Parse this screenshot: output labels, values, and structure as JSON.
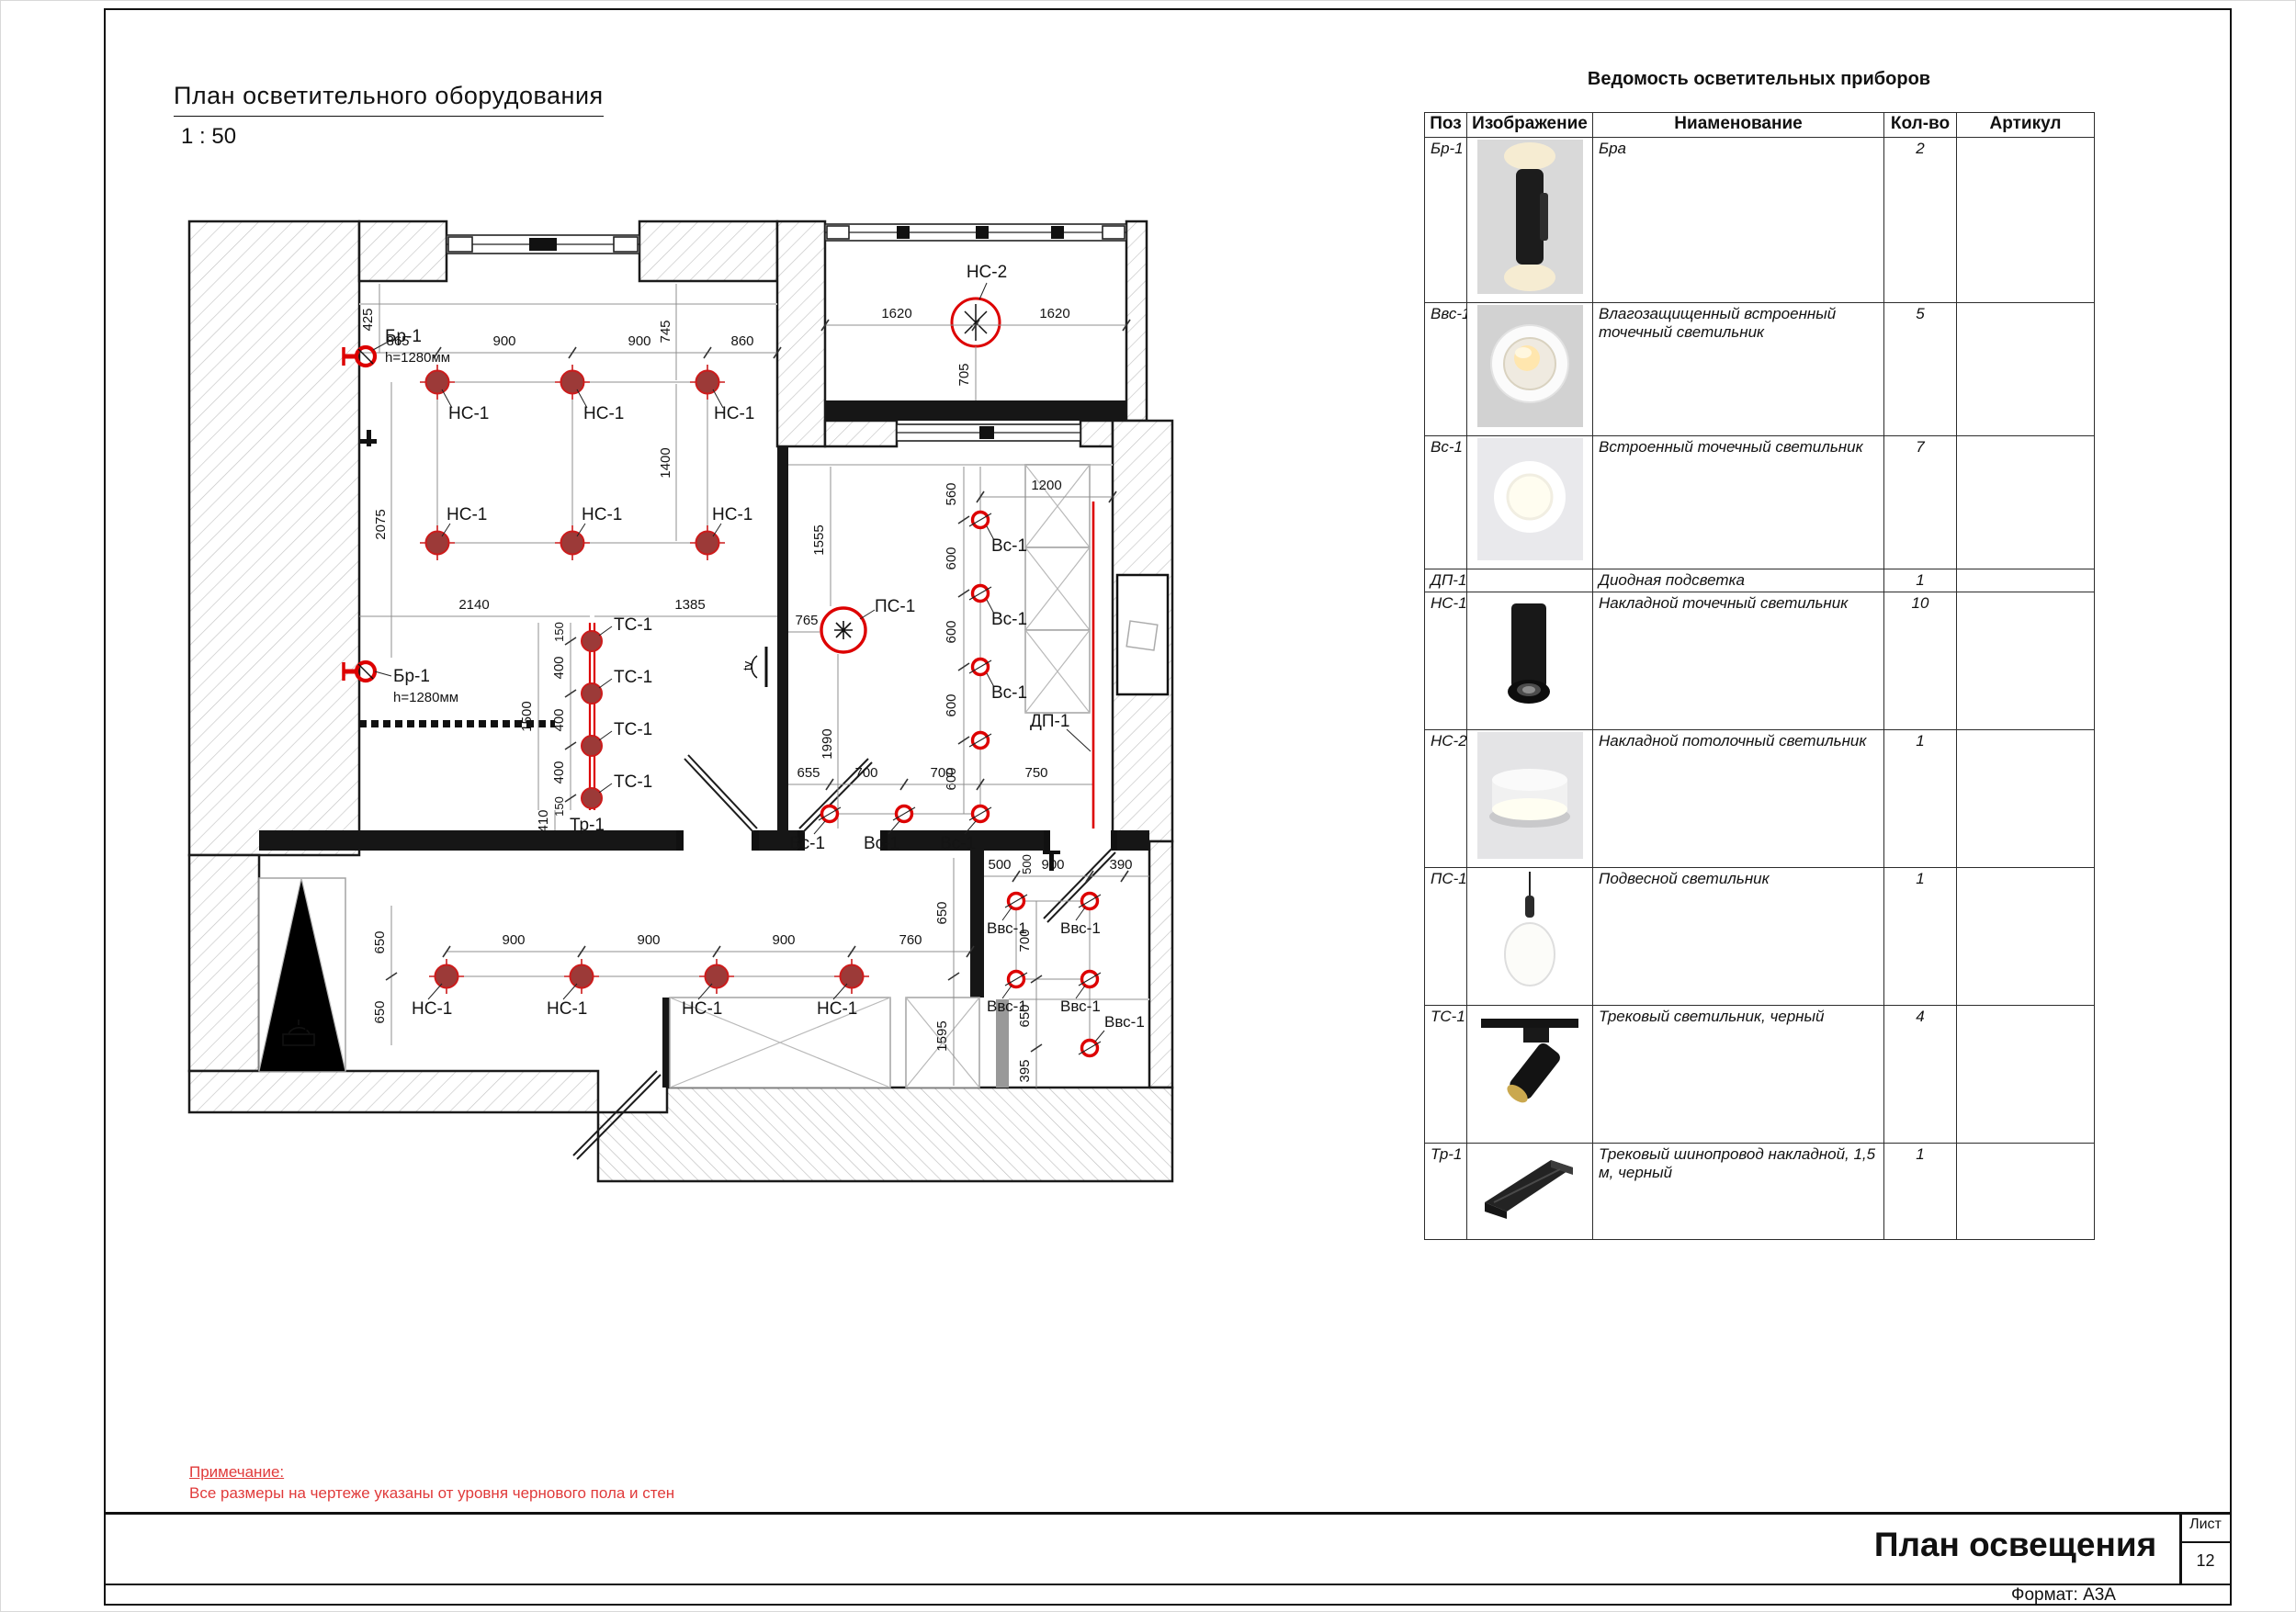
{
  "header": {
    "title": "План осветительного оборудования",
    "scale": "1 : 50"
  },
  "table": {
    "title": "Ведомость осветительных приборов",
    "headers": [
      "Поз",
      "Изображение",
      "Ниаменование",
      "Кол-во",
      "Артикул"
    ],
    "rows": [
      {
        "pos": "Бр-1",
        "name": "Бра",
        "qty": "2",
        "article": ""
      },
      {
        "pos": "Ввс-1",
        "name": "Влагозащищенный встроенный точечный светильник",
        "qty": "5",
        "article": ""
      },
      {
        "pos": "Вс-1",
        "name": "Встроенный точечный светильник",
        "qty": "7",
        "article": ""
      },
      {
        "pos": "ДП-1",
        "name": "Диодная подсветка",
        "qty": "1",
        "article": ""
      },
      {
        "pos": "НС-1",
        "name": "Накладной точечный светильник",
        "qty": "10",
        "article": ""
      },
      {
        "pos": "НС-2",
        "name": "Накладной потолочный светильник",
        "qty": "1",
        "article": ""
      },
      {
        "pos": "ПС-1",
        "name": "Подвесной светильник",
        "qty": "1",
        "article": ""
      },
      {
        "pos": "ТС-1",
        "name": "Трековый светильник, черный",
        "qty": "4",
        "article": ""
      },
      {
        "pos": "Тр-1",
        "name": "Трековый шинопровод накладной, 1,5 м, черный",
        "qty": "1",
        "article": ""
      }
    ]
  },
  "plan": {
    "labels": {
      "ns1": "НС-1",
      "ns2": "НС-2",
      "vs1": "Вс-1",
      "vvs1": "Ввс-1",
      "ps1": "ПС-1",
      "ts1": "ТС-1",
      "tr1": "Тр-1",
      "dp1": "ДП-1",
      "br1": "Бр-1",
      "br1h": "h=1280мм",
      "tv": "tv",
      "fan": "F"
    },
    "dims": {
      "d150": "150",
      "d390": "390",
      "d395": "395",
      "d400": "400",
      "d410": "410",
      "d425": "425",
      "d500": "500",
      "d560": "560",
      "d600": "600",
      "d650": "650",
      "d655": "655",
      "d700": "700",
      "d705": "705",
      "d745": "745",
      "d750": "750",
      "d760": "760",
      "d765": "765",
      "d860": "860",
      "d865": "865",
      "d900": "900",
      "d1200": "1200",
      "d1385": "1385",
      "d1400": "1400",
      "d1500": "1500",
      "d1555": "1555",
      "d1595": "1595",
      "d1620": "1620",
      "d1990": "1990",
      "d2075": "2075",
      "d2140": "2140"
    }
  },
  "note": {
    "title": "Примечание:",
    "text": "Все размеры на чертеже указаны от уровня чернового пола и стен"
  },
  "titleblock": {
    "title": "План освещения",
    "sheet_label": "Лист",
    "sheet_number": "12",
    "format_label": "Формат: А3А"
  },
  "colors": {
    "accent_red": "#dd0000",
    "fixture_fill": "#9c3a38",
    "note_red": "#e03a3a"
  }
}
